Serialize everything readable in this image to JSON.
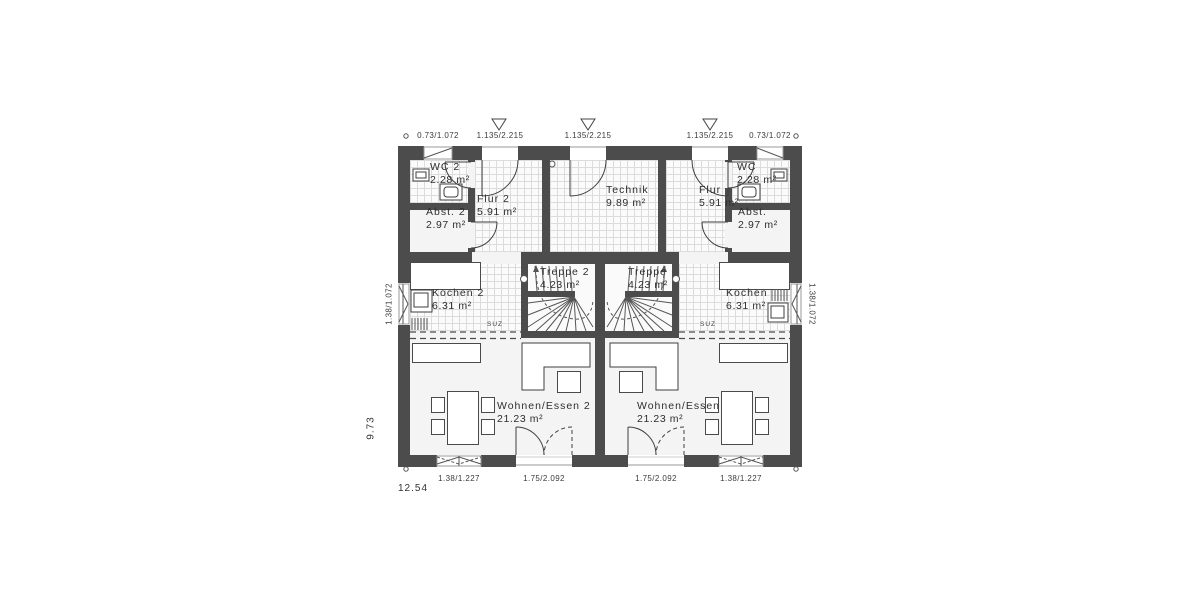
{
  "plan": {
    "rooms": [
      {
        "name": "WC 2",
        "area": "2.28 m²"
      },
      {
        "name": "Flur 2",
        "area": "5.91 m²"
      },
      {
        "name": "Abst. 2",
        "area": "2.97 m²"
      },
      {
        "name": "Technik",
        "area": "9.89 m²"
      },
      {
        "name": "Flur",
        "area": "5.91 m²"
      },
      {
        "name": "WC",
        "area": "2.28 m²"
      },
      {
        "name": "Abst.",
        "area": "2.97 m²"
      },
      {
        "name": "Kochen 2",
        "area": "6.31 m²"
      },
      {
        "name": "Treppe 2",
        "area": "4.23 m²"
      },
      {
        "name": "Treppe",
        "area": "4.23 m²"
      },
      {
        "name": "Kochen",
        "area": "6.31 m²"
      },
      {
        "name": "Wohnen/Essen 2",
        "area": "21.23 m²"
      },
      {
        "name": "Wohnen/Essen",
        "area": "21.23 m²"
      }
    ],
    "dims_top": [
      "0.73/1.072",
      "1.135/2.215",
      "1.135/2.215",
      "1.135/2.215",
      "0.73/1.072"
    ],
    "dims_bottom": [
      "1.38/1.227",
      "1.75/2.092",
      "1.75/2.092",
      "1.38/1.227"
    ],
    "dim_left_window": "1.38/1.072",
    "dim_right_window": "1.38/1.072",
    "overall_width": "12.54",
    "overall_depth": "9.73",
    "suz_left": "SUZ",
    "suz_right": "SUZ"
  },
  "colors": {
    "wall": "#4c4c4c",
    "line": "#3f3f3f",
    "tile": "#dcdcdc"
  }
}
